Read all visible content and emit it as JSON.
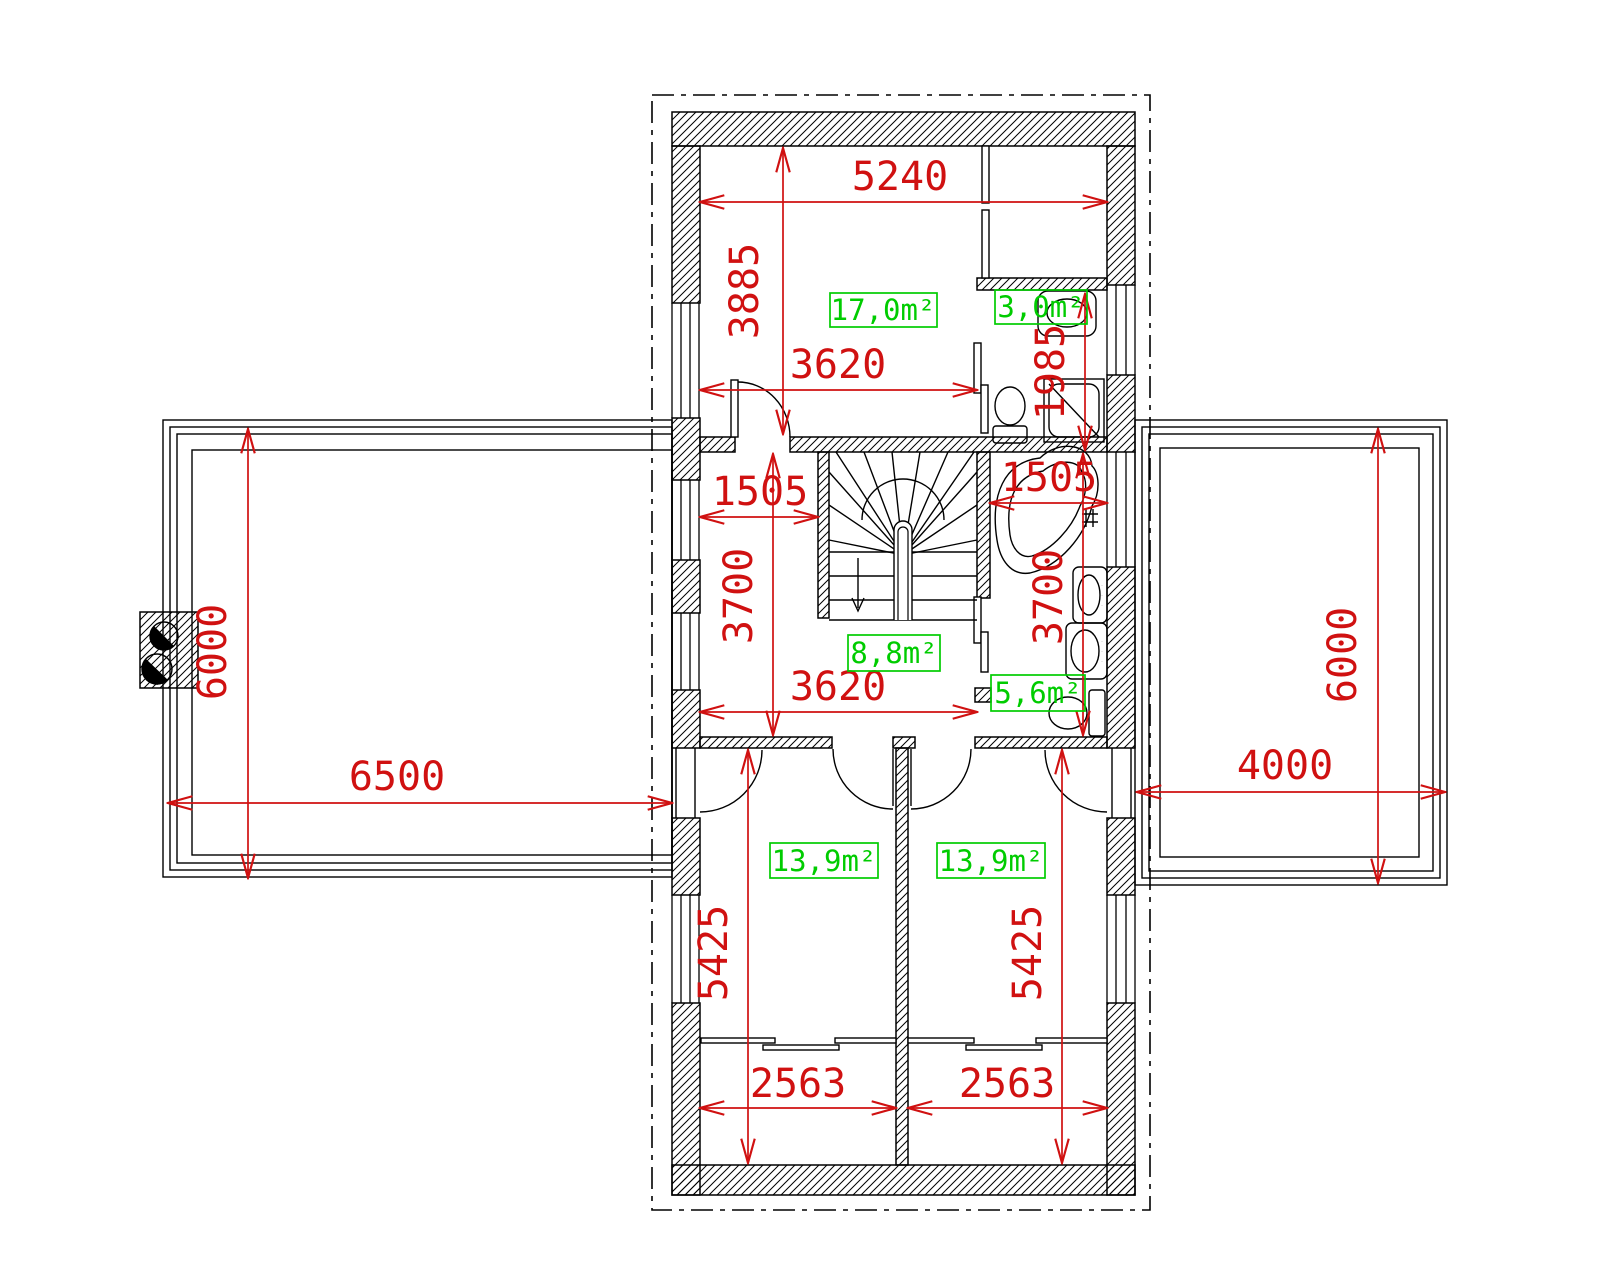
{
  "plan_title": "first-floor-plan",
  "colors": {
    "dimension_red": "#d01111",
    "area_green": "#00cc00",
    "drawing_black": "#000000"
  },
  "rooms": [
    {
      "id": "bedroom-top",
      "area": "17,0m²"
    },
    {
      "id": "bathroom-top",
      "area": "3,0m²"
    },
    {
      "id": "hall-stairs",
      "area": "8,8m²"
    },
    {
      "id": "bathroom-main",
      "area": "5,6m²"
    },
    {
      "id": "bedroom-left",
      "area": "13,9m²"
    },
    {
      "id": "bedroom-right",
      "area": "13,9m²"
    }
  ],
  "dimensions": {
    "top_room_width": "5240",
    "top_room_height": "3885",
    "hall_width_upper": "3620",
    "hall_niche_width": "1505",
    "hall_height": "3700",
    "hall_width_lower": "3620",
    "bath_width": "1505",
    "bath_height": "3700",
    "small_bath_height": "1985",
    "bedroom_left_height": "5425",
    "bedroom_right_height": "5425",
    "bedroom_left_width": "2563",
    "bedroom_right_width": "2563",
    "left_terrace_height": "6000",
    "left_terrace_width": "6500",
    "right_terrace_height": "6000",
    "right_terrace_width": "4000"
  }
}
